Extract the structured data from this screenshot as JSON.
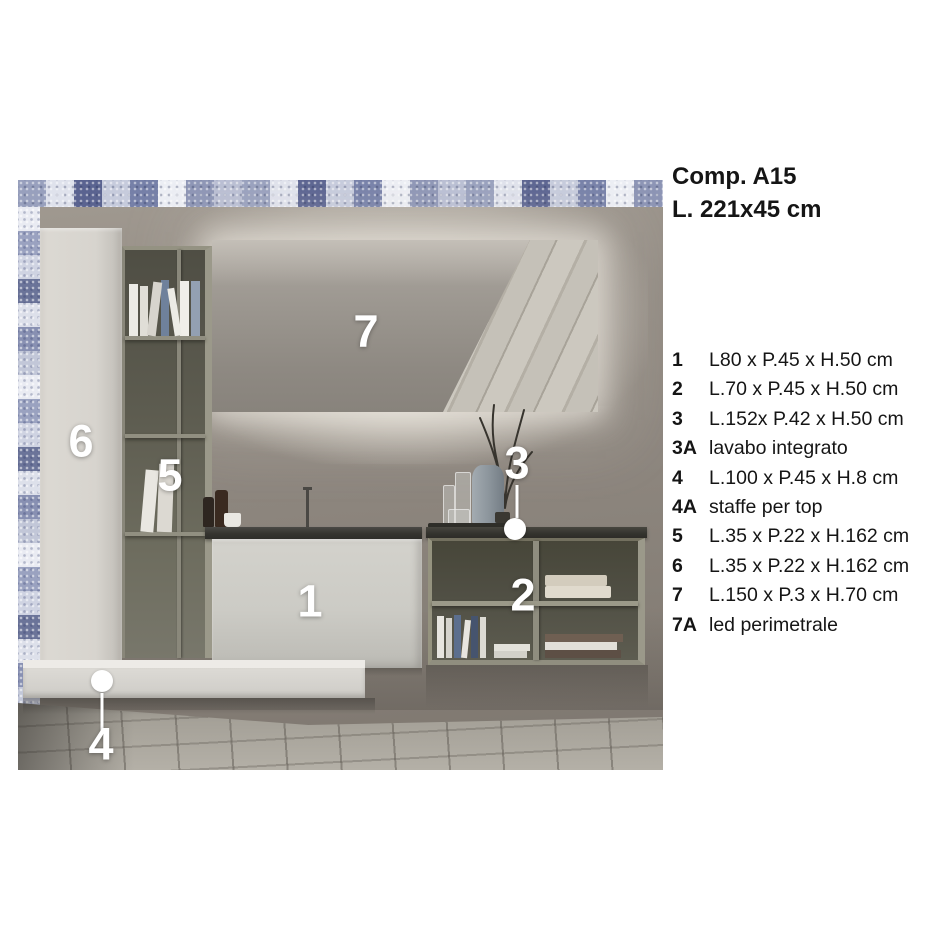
{
  "header": {
    "title": "Comp. A15",
    "size": "L. 221x45 cm"
  },
  "specs": [
    {
      "num": "1",
      "desc": "L80 x P.45 x H.50 cm"
    },
    {
      "num": "2",
      "desc": "L.70 x P.45 x H.50 cm"
    },
    {
      "num": "3",
      "desc": "L.152x P.42 x H.50 cm"
    },
    {
      "num": "3A",
      "desc": "lavabo integrato"
    },
    {
      "num": "4",
      "desc": "L.100 x P.45 x H.8 cm"
    },
    {
      "num": "4A",
      "desc": "staffe per top"
    },
    {
      "num": "5",
      "desc": "L.35 x P.22 x H.162 cm"
    },
    {
      "num": "6",
      "desc": "L.35 x P.22 x H.162 cm"
    },
    {
      "num": "7",
      "desc": "L.150 x P.3 x H.70 cm"
    },
    {
      "num": "7A",
      "desc": "led perimetrale"
    }
  ],
  "photo": {
    "labels": {
      "vanity": "1",
      "shelf_right": "2",
      "basin_top": "3",
      "bottom_shelf": "4",
      "shelf_left": "5",
      "tall_cabinet": "6",
      "mirror": "7"
    }
  },
  "colors": {
    "wall": "#8c857d",
    "tile_accent": "#6b7499",
    "furniture_light": "#d6d3cd",
    "furniture_olive": "#8d8b7d",
    "counter_dark": "#35342f",
    "label_white": "#ffffff"
  }
}
